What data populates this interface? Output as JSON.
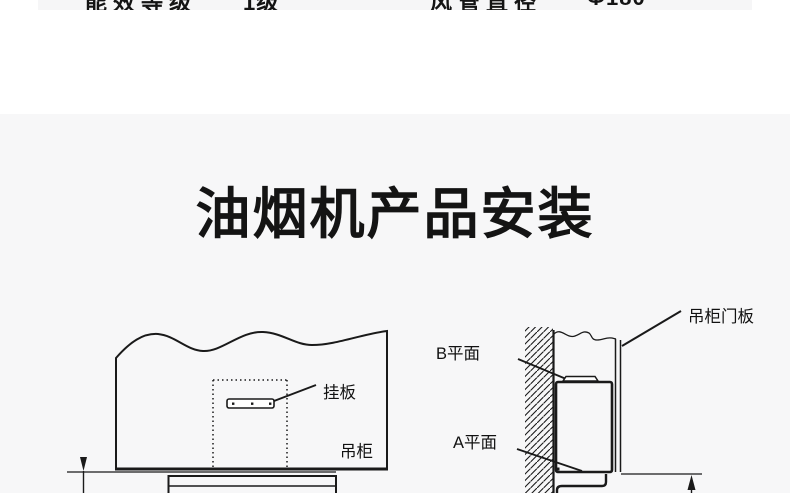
{
  "spec_row": {
    "left_label": "能效等级",
    "left_value": "1级",
    "right_label": "风管直径",
    "right_value": "Φ180"
  },
  "title": "油烟机产品安装",
  "diagram_left": {
    "hang_plate_label": "挂板",
    "cabinet_label": "吊柜"
  },
  "diagram_right": {
    "b_plane_label": "B平面",
    "a_plane_label": "A平面",
    "door_panel_label": "吊柜门板"
  },
  "colors": {
    "ink": "#1a1a1a",
    "panel_bg": "#f7f7f8"
  }
}
